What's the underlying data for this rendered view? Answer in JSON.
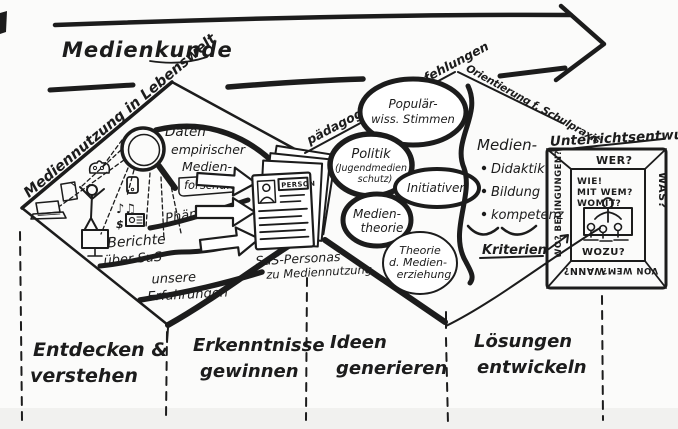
{
  "header": {
    "arrow_label": "Medienkunde"
  },
  "edges": {
    "diamond1": "Mediennutzung in Lebenswelt",
    "diamond2_up": "pädagogische Empfehlungen",
    "diamond2_down": "Orientierung f. Schulpraxis"
  },
  "discover": {
    "research_l1": "Daten",
    "research_l2": "empirischer",
    "research_l3": "Medien-",
    "research_l4": "forschung",
    "phenomena": "Phänomene",
    "reports_l1": "Berichte",
    "reports_l2": "über SuS",
    "experience_l1": "unsere",
    "experience_l2": "Erfahrungen"
  },
  "icons": {
    "music": "♪♫",
    "dollar": "$"
  },
  "personas": {
    "card_header": "PERSON",
    "caption_l1": "SuS-Personas",
    "caption_l2": "zu Mediennutzung"
  },
  "bubbles": {
    "popular_l1": "Populär-",
    "popular_l2": "wiss. Stimmen",
    "politics_l1": "Politik",
    "politics_l2": "(Jugendmedien",
    "politics_l3": "schutz)",
    "initiatives": "Initiativen",
    "mediatheory_l1": "Medien-",
    "mediatheory_l2": "theorie",
    "theory_l1": "Theorie",
    "theory_l2": "d. Medien-",
    "theory_l3": "erziehung"
  },
  "criteria": {
    "heading": "Medien-",
    "bullet1": "Didaktik",
    "bullet2": "Bildung",
    "bullet3": "kompetenz",
    "label": "Kriterien"
  },
  "frame": {
    "title": "Unterrichtsentwurf",
    "who": "WER?",
    "what": "WAS?",
    "where": "WO? BEDINGUNGEN?",
    "when": "WANN?",
    "by_whom": "VON WEM?",
    "how": "WIE!",
    "with_whom": "MIT WEM?",
    "with_what": "WOMIT?",
    "why": "WOZU?"
  },
  "phases": [
    {
      "l1": "Entdecken &",
      "l2": "verstehen"
    },
    {
      "l1": "Erkenntnisse",
      "l2": "gewinnen"
    },
    {
      "l1": "Ideen",
      "l2": "generieren"
    },
    {
      "l1": "Lösungen",
      "l2": "entwickeln"
    }
  ],
  "colors": {
    "ink": "#1c1c1c",
    "paper": "#fbfbfa"
  }
}
